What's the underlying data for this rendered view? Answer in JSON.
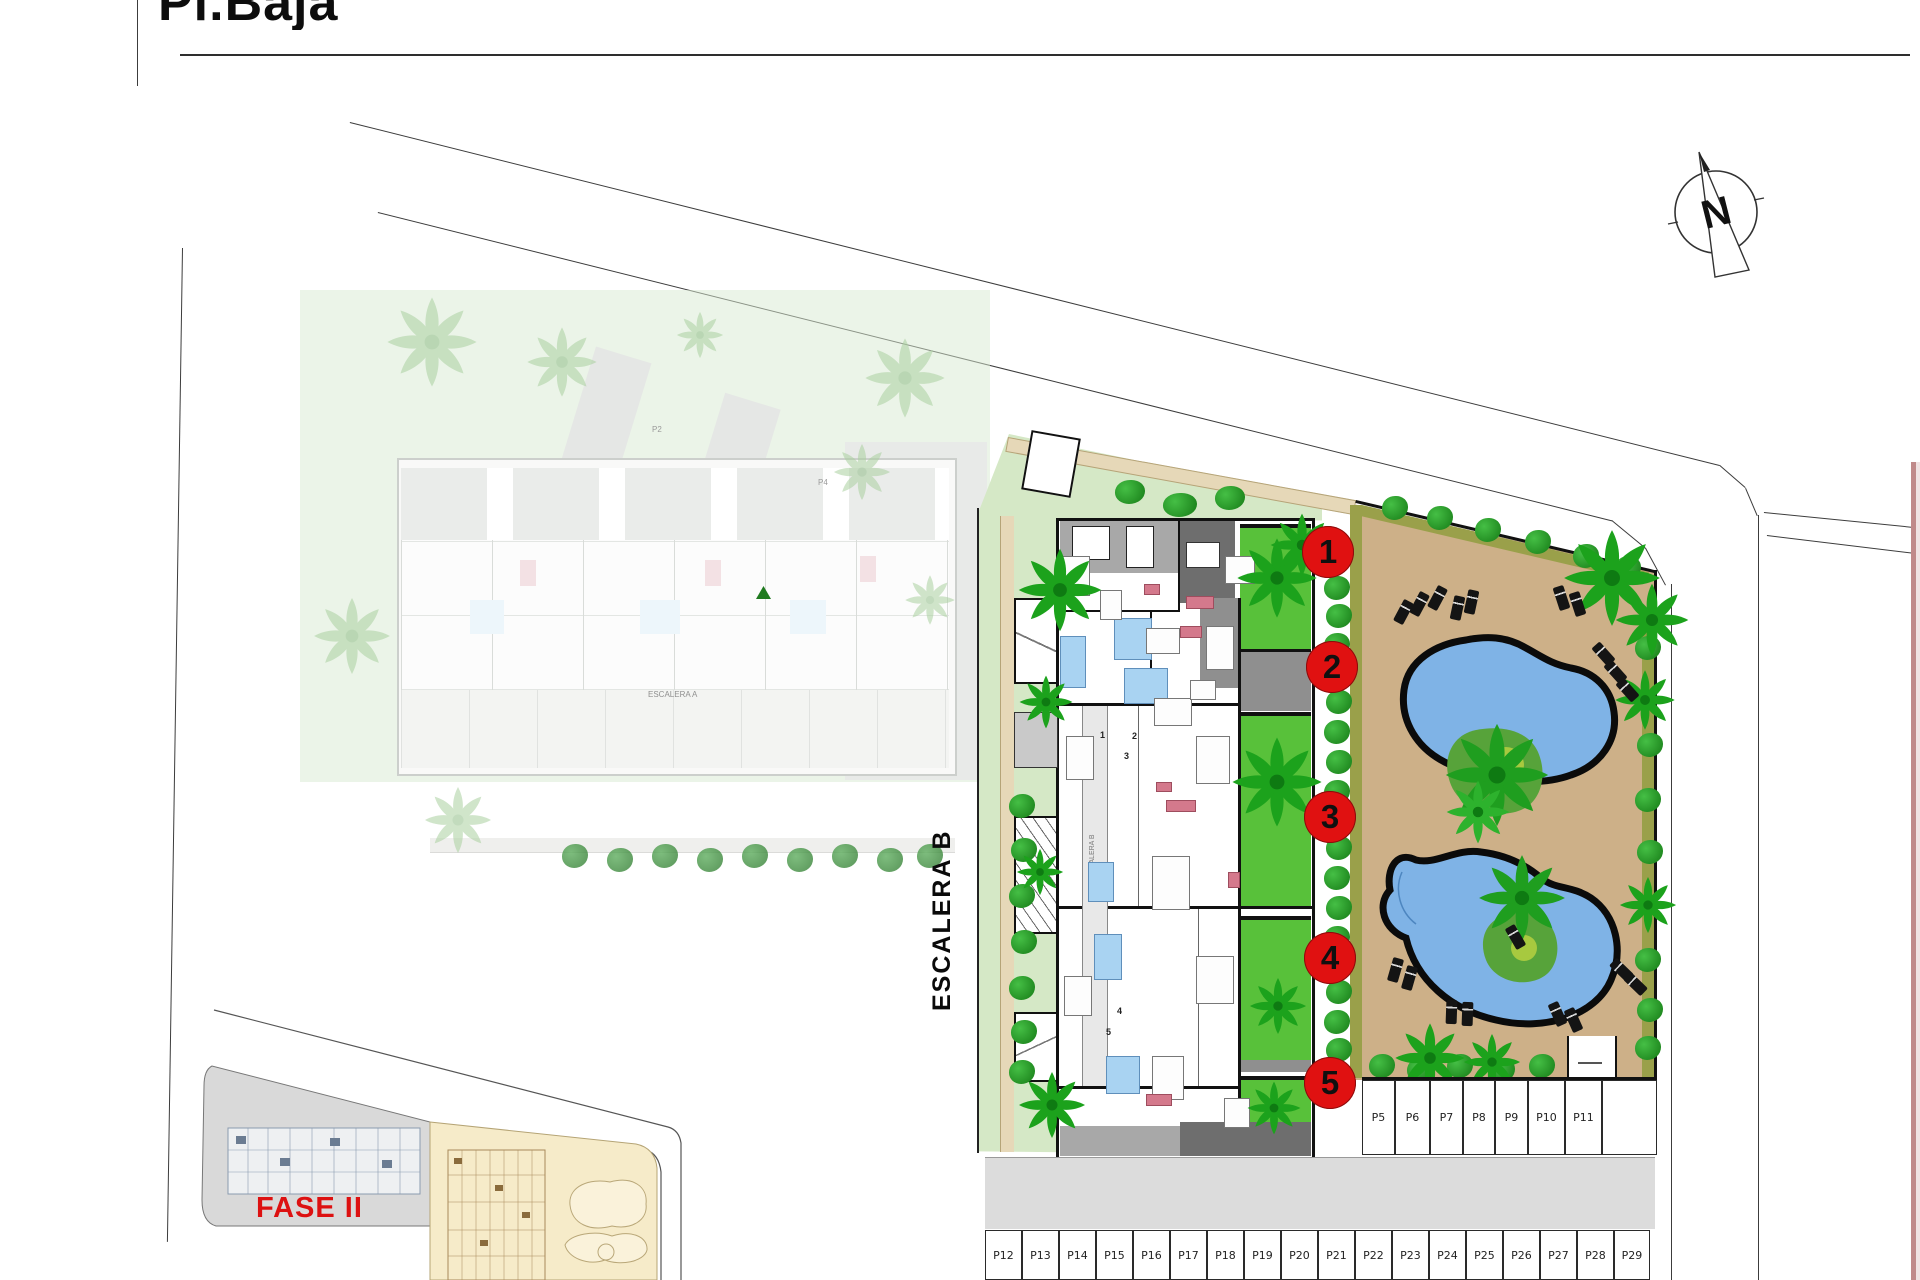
{
  "title": "Pl.Baja",
  "compass": {
    "letter": "N"
  },
  "labels": {
    "escalera_b": "ESCALERA B",
    "escalera_b_inner": "ESCALERA B",
    "escalera_a_inner": "ESCALERA A",
    "fase2": "FASE II"
  },
  "colors": {
    "accent_red": "#e01111",
    "deck_tan": "#cdb088",
    "path_tan": "#e6d8b8",
    "olive": "#9aa04a",
    "pool_blue": "#7fb3e6",
    "pool_outline": "#0b0b0b",
    "lawn_pale": "#d5e8c6",
    "garden_green": "#58c13a",
    "hedge_green": "#2aa82a",
    "terrace_dark": "#6e6e6e",
    "terrace_light": "#a8a8a8",
    "bath_blue": "#a9d3f2",
    "sofa_pink": "#d4798c",
    "road_gray": "#dcdcdc",
    "key_gray": "#d9d9d9",
    "key_yellow": "#f6ebc9"
  },
  "unit_markers": [
    {
      "n": "1",
      "x": 1328,
      "y": 552
    },
    {
      "n": "2",
      "x": 1332,
      "y": 667
    },
    {
      "n": "3",
      "x": 1330,
      "y": 817
    },
    {
      "n": "4",
      "x": 1330,
      "y": 958
    },
    {
      "n": "5",
      "x": 1330,
      "y": 1083
    }
  ],
  "unit_numbers_tiny": [
    {
      "n": "1",
      "x": 1100,
      "y": 730
    },
    {
      "n": "2",
      "x": 1132,
      "y": 731
    },
    {
      "n": "3",
      "x": 1124,
      "y": 751
    },
    {
      "n": "4",
      "x": 1117,
      "y": 1006
    },
    {
      "n": "5",
      "x": 1106,
      "y": 1027
    }
  ],
  "faint_labels": [
    {
      "t": "P2",
      "x": 652,
      "y": 425
    },
    {
      "t": "P4",
      "x": 818,
      "y": 478
    }
  ],
  "parking_top": {
    "y": 1080,
    "h": 75,
    "cells": [
      {
        "label": "P5",
        "x": 1362,
        "w": 33
      },
      {
        "label": "P6",
        "x": 1395,
        "w": 35
      },
      {
        "label": "P7",
        "x": 1430,
        "w": 33
      },
      {
        "label": "P8",
        "x": 1463,
        "w": 32
      },
      {
        "label": "P9",
        "x": 1495,
        "w": 33
      },
      {
        "label": "P10",
        "x": 1528,
        "w": 37
      },
      {
        "label": "P11",
        "x": 1565,
        "w": 37
      },
      {
        "label": "",
        "x": 1602,
        "w": 55
      }
    ]
  },
  "parking_bottom": {
    "y": 1230,
    "h": 50,
    "cells": [
      {
        "label": "P12",
        "x": 985,
        "w": 37
      },
      {
        "label": "P13",
        "x": 1022,
        "w": 37
      },
      {
        "label": "P14",
        "x": 1059,
        "w": 37
      },
      {
        "label": "P15",
        "x": 1096,
        "w": 37
      },
      {
        "label": "P16",
        "x": 1133,
        "w": 37
      },
      {
        "label": "P17",
        "x": 1170,
        "w": 37
      },
      {
        "label": "P18",
        "x": 1207,
        "w": 37
      },
      {
        "label": "P19",
        "x": 1244,
        "w": 37
      },
      {
        "label": "P20",
        "x": 1281,
        "w": 37
      },
      {
        "label": "P21",
        "x": 1318,
        "w": 37
      },
      {
        "label": "P22",
        "x": 1355,
        "w": 37
      },
      {
        "label": "P23",
        "x": 1392,
        "w": 37
      },
      {
        "label": "P24",
        "x": 1429,
        "w": 37
      },
      {
        "label": "P25",
        "x": 1466,
        "w": 37
      },
      {
        "label": "P26",
        "x": 1503,
        "w": 37
      },
      {
        "label": "P27",
        "x": 1540,
        "w": 37
      },
      {
        "label": "P28",
        "x": 1577,
        "w": 37
      },
      {
        "label": "P29",
        "x": 1614,
        "w": 36
      }
    ]
  },
  "palms": [
    {
      "x": 1060,
      "y": 590,
      "s": 1.25
    },
    {
      "x": 1046,
      "y": 702,
      "s": 0.8
    },
    {
      "x": 1040,
      "y": 872,
      "s": 0.7
    },
    {
      "x": 1052,
      "y": 1105,
      "s": 1.0
    },
    {
      "x": 1277,
      "y": 578,
      "s": 1.2
    },
    {
      "x": 1302,
      "y": 545,
      "s": 0.95
    },
    {
      "x": 1277,
      "y": 782,
      "s": 1.35
    },
    {
      "x": 1278,
      "y": 1006,
      "s": 0.85
    },
    {
      "x": 1274,
      "y": 1108,
      "s": 0.8
    },
    {
      "x": 1612,
      "y": 578,
      "s": 1.45
    },
    {
      "x": 1652,
      "y": 620,
      "s": 1.1
    },
    {
      "x": 1497,
      "y": 775,
      "s": 1.55,
      "c": "#1f9e1f"
    },
    {
      "x": 1478,
      "y": 812,
      "s": 0.95,
      "c": "#2db22d"
    },
    {
      "x": 1522,
      "y": 898,
      "s": 1.3,
      "c": "#1f9e1f"
    },
    {
      "x": 1430,
      "y": 1058,
      "s": 1.05
    },
    {
      "x": 1492,
      "y": 1062,
      "s": 0.85
    },
    {
      "x": 1645,
      "y": 700,
      "s": 0.9
    },
    {
      "x": 1648,
      "y": 905,
      "s": 0.85
    }
  ],
  "faded_palms": [
    {
      "x": 432,
      "y": 342,
      "s": 1.35
    },
    {
      "x": 562,
      "y": 362,
      "s": 1.05
    },
    {
      "x": 905,
      "y": 378,
      "s": 1.2
    },
    {
      "x": 352,
      "y": 636,
      "s": 1.15
    },
    {
      "x": 862,
      "y": 472,
      "s": 0.85
    },
    {
      "x": 930,
      "y": 600,
      "s": 0.75
    },
    {
      "x": 458,
      "y": 820,
      "s": 1.0
    },
    {
      "x": 700,
      "y": 335,
      "s": 0.7
    }
  ],
  "bushes": [
    {
      "x": 1022,
      "y": 806
    },
    {
      "x": 1024,
      "y": 850
    },
    {
      "x": 1022,
      "y": 896
    },
    {
      "x": 1024,
      "y": 942
    },
    {
      "x": 1022,
      "y": 988
    },
    {
      "x": 1024,
      "y": 1032
    },
    {
      "x": 1022,
      "y": 1072
    },
    {
      "x": 1337,
      "y": 588
    },
    {
      "x": 1339,
      "y": 616
    },
    {
      "x": 1337,
      "y": 645
    },
    {
      "x": 1339,
      "y": 702
    },
    {
      "x": 1337,
      "y": 732
    },
    {
      "x": 1339,
      "y": 762
    },
    {
      "x": 1337,
      "y": 792
    },
    {
      "x": 1339,
      "y": 848
    },
    {
      "x": 1337,
      "y": 878
    },
    {
      "x": 1339,
      "y": 908
    },
    {
      "x": 1337,
      "y": 938
    },
    {
      "x": 1339,
      "y": 992
    },
    {
      "x": 1337,
      "y": 1022
    },
    {
      "x": 1339,
      "y": 1050
    },
    {
      "x": 1395,
      "y": 508
    },
    {
      "x": 1440,
      "y": 518
    },
    {
      "x": 1488,
      "y": 530
    },
    {
      "x": 1538,
      "y": 542
    },
    {
      "x": 1586,
      "y": 556
    },
    {
      "x": 1628,
      "y": 568
    },
    {
      "x": 1648,
      "y": 648
    },
    {
      "x": 1650,
      "y": 745
    },
    {
      "x": 1648,
      "y": 800
    },
    {
      "x": 1650,
      "y": 852
    },
    {
      "x": 1648,
      "y": 960
    },
    {
      "x": 1650,
      "y": 1010
    },
    {
      "x": 1648,
      "y": 1048
    },
    {
      "x": 1382,
      "y": 1066
    },
    {
      "x": 1420,
      "y": 1070
    },
    {
      "x": 1460,
      "y": 1066
    },
    {
      "x": 1502,
      "y": 1070
    },
    {
      "x": 1542,
      "y": 1066
    },
    {
      "x": 1180,
      "y": 505,
      "w": 34
    },
    {
      "x": 1230,
      "y": 498,
      "w": 30
    },
    {
      "x": 1130,
      "y": 492,
      "w": 30
    }
  ],
  "faded_bushes": [
    {
      "x": 575,
      "y": 856
    },
    {
      "x": 620,
      "y": 860
    },
    {
      "x": 665,
      "y": 856
    },
    {
      "x": 710,
      "y": 860
    },
    {
      "x": 755,
      "y": 856
    },
    {
      "x": 800,
      "y": 860
    },
    {
      "x": 845,
      "y": 856
    },
    {
      "x": 890,
      "y": 860
    },
    {
      "x": 930,
      "y": 856
    }
  ],
  "loungers": [
    {
      "x": 1398,
      "y": 600,
      "r": 28
    },
    {
      "x": 1414,
      "y": 592,
      "r": 28
    },
    {
      "x": 1432,
      "y": 586,
      "r": 28
    },
    {
      "x": 1452,
      "y": 596,
      "r": 12
    },
    {
      "x": 1466,
      "y": 590,
      "r": 12
    },
    {
      "x": 1556,
      "y": 586,
      "r": -18
    },
    {
      "x": 1572,
      "y": 592,
      "r": -18
    },
    {
      "x": 1598,
      "y": 642,
      "r": -42
    },
    {
      "x": 1610,
      "y": 660,
      "r": -42
    },
    {
      "x": 1622,
      "y": 678,
      "r": -42
    },
    {
      "x": 1390,
      "y": 958,
      "r": 16
    },
    {
      "x": 1404,
      "y": 966,
      "r": 16
    },
    {
      "x": 1446,
      "y": 1000,
      "r": 2
    },
    {
      "x": 1462,
      "y": 1002,
      "r": 2
    },
    {
      "x": 1552,
      "y": 1002,
      "r": -24
    },
    {
      "x": 1568,
      "y": 1008,
      "r": -24
    },
    {
      "x": 1616,
      "y": 958,
      "r": -46
    },
    {
      "x": 1630,
      "y": 972,
      "r": -46
    },
    {
      "x": 1510,
      "y": 925,
      "r": -30
    }
  ],
  "furniture": {
    "blue": [
      [
        1060,
        636,
        26,
        52
      ],
      [
        1114,
        618,
        38,
        42
      ],
      [
        1124,
        668,
        44,
        36
      ],
      [
        1088,
        862,
        26,
        40
      ],
      [
        1094,
        934,
        28,
        46
      ],
      [
        1106,
        1056,
        34,
        38
      ]
    ],
    "pink": [
      [
        1144,
        584,
        16,
        11
      ],
      [
        1186,
        596,
        28,
        13
      ],
      [
        1156,
        782,
        16,
        10
      ],
      [
        1166,
        800,
        30,
        12
      ],
      [
        1228,
        872,
        12,
        16
      ],
      [
        1146,
        1094,
        26,
        12
      ],
      [
        1180,
        626,
        22,
        12
      ]
    ],
    "gray": [
      [
        1062,
        556,
        28,
        40
      ],
      [
        1146,
        628,
        34,
        26
      ],
      [
        1206,
        626,
        28,
        44
      ],
      [
        1225,
        556,
        30,
        28
      ],
      [
        1066,
        736,
        28,
        44
      ],
      [
        1154,
        698,
        38,
        28
      ],
      [
        1196,
        736,
        34,
        48
      ],
      [
        1064,
        976,
        28,
        40
      ],
      [
        1152,
        856,
        38,
        54
      ],
      [
        1196,
        956,
        38,
        48
      ],
      [
        1152,
        1056,
        32,
        44
      ],
      [
        1224,
        1098,
        26,
        30
      ],
      [
        1100,
        590,
        22,
        30
      ],
      [
        1190,
        680,
        26,
        20
      ]
    ]
  }
}
